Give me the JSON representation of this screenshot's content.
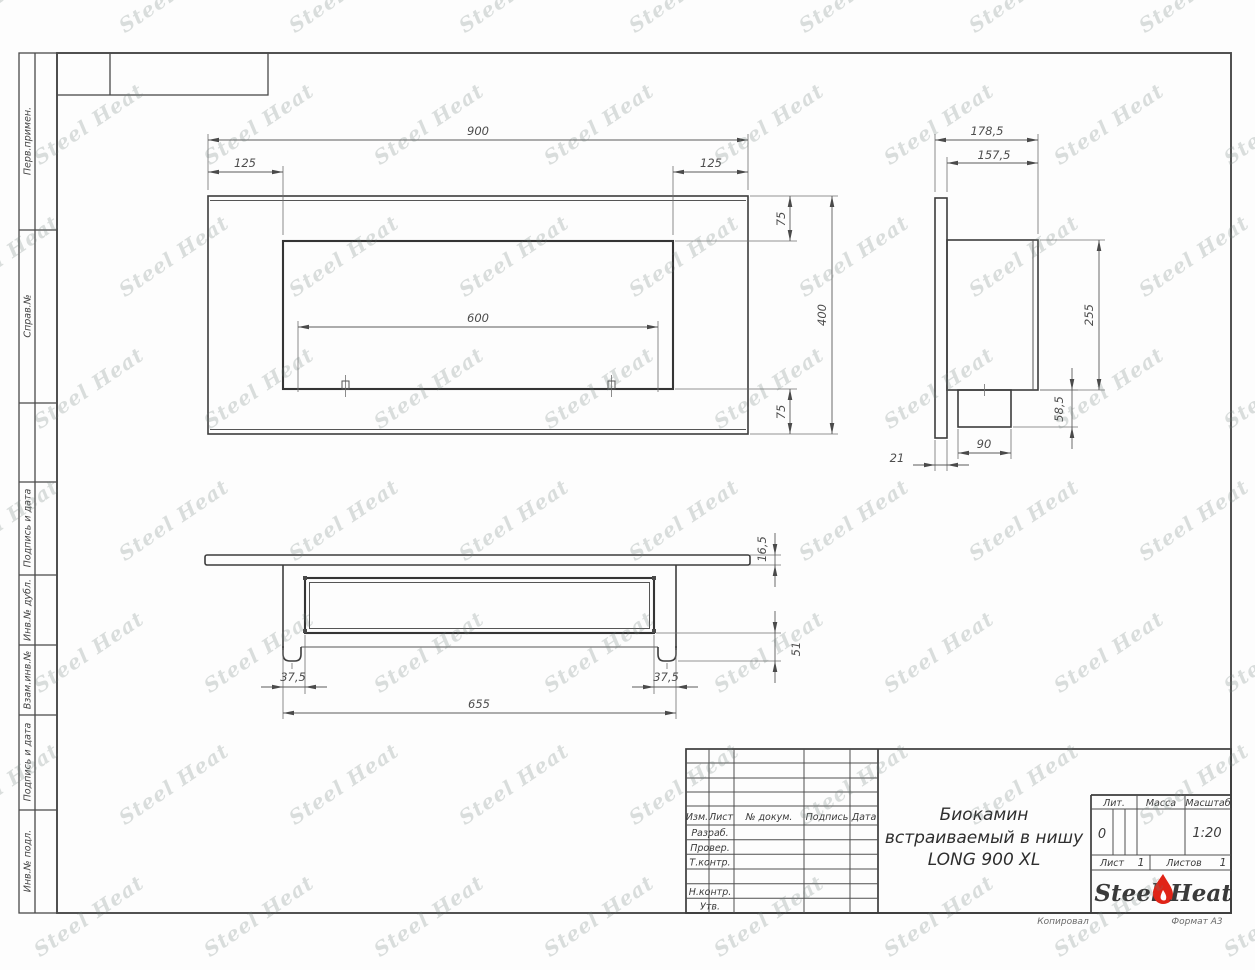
{
  "sheet": {
    "copy_note": "Копировал",
    "format_note": "Формат А3"
  },
  "watermark": {
    "text": "Steel Heat"
  },
  "margin": {
    "labels": [
      "Перв.примен.",
      "Справ.№",
      "Подпись и дата",
      "Инв.№ дубл.",
      "Взам.инв.№",
      "Подпись и дата",
      "Инв.№ подл."
    ]
  },
  "views": {
    "front": {
      "name": "Фронтальный вид",
      "dims": {
        "width_total": "900",
        "offset_left": "125",
        "offset_right": "125",
        "opening_width": "600",
        "margin_top": "75",
        "height_total": "400",
        "margin_bottom": "75"
      }
    },
    "side": {
      "name": "Вид сбоку",
      "dims": {
        "depth_total": "178,5",
        "body_depth": "157,5",
        "body_height": "255",
        "burner_height": "58,5",
        "burner_width": "90",
        "panel_thickness": "21"
      }
    },
    "bottom": {
      "name": "Вид снизу",
      "dims": {
        "panel_thickness": "16,5",
        "inner_depth": "51",
        "inset_left": "37,5",
        "inset_right": "37,5",
        "body_width": "655"
      }
    }
  },
  "title_block": {
    "cols": {
      "izm": "Изм.",
      "list": "Лист",
      "doc": "№ докум.",
      "sign": "Подпись",
      "date": "Дата"
    },
    "rows": {
      "developed": "Разраб.",
      "checked": "Провер.",
      "tcontrol": "Т.контр.",
      "ncontrol": "Н.контр.",
      "approved": "Утв."
    },
    "title_lines": [
      "Биокамин",
      "встраиваемый в нишу",
      "LONG 900 XL"
    ],
    "lit": {
      "label": "Лит.",
      "value": "0"
    },
    "mass": {
      "label": "Масса",
      "value": ""
    },
    "scale": {
      "label": "Масштаб",
      "value": "1:20"
    },
    "sheet": {
      "label": "Лист",
      "value": "1"
    },
    "sheets": {
      "label": "Листов",
      "value": "1"
    },
    "logo": {
      "steel": "Steel",
      "heat": "Heat",
      "flame_color": "#e02417"
    }
  }
}
